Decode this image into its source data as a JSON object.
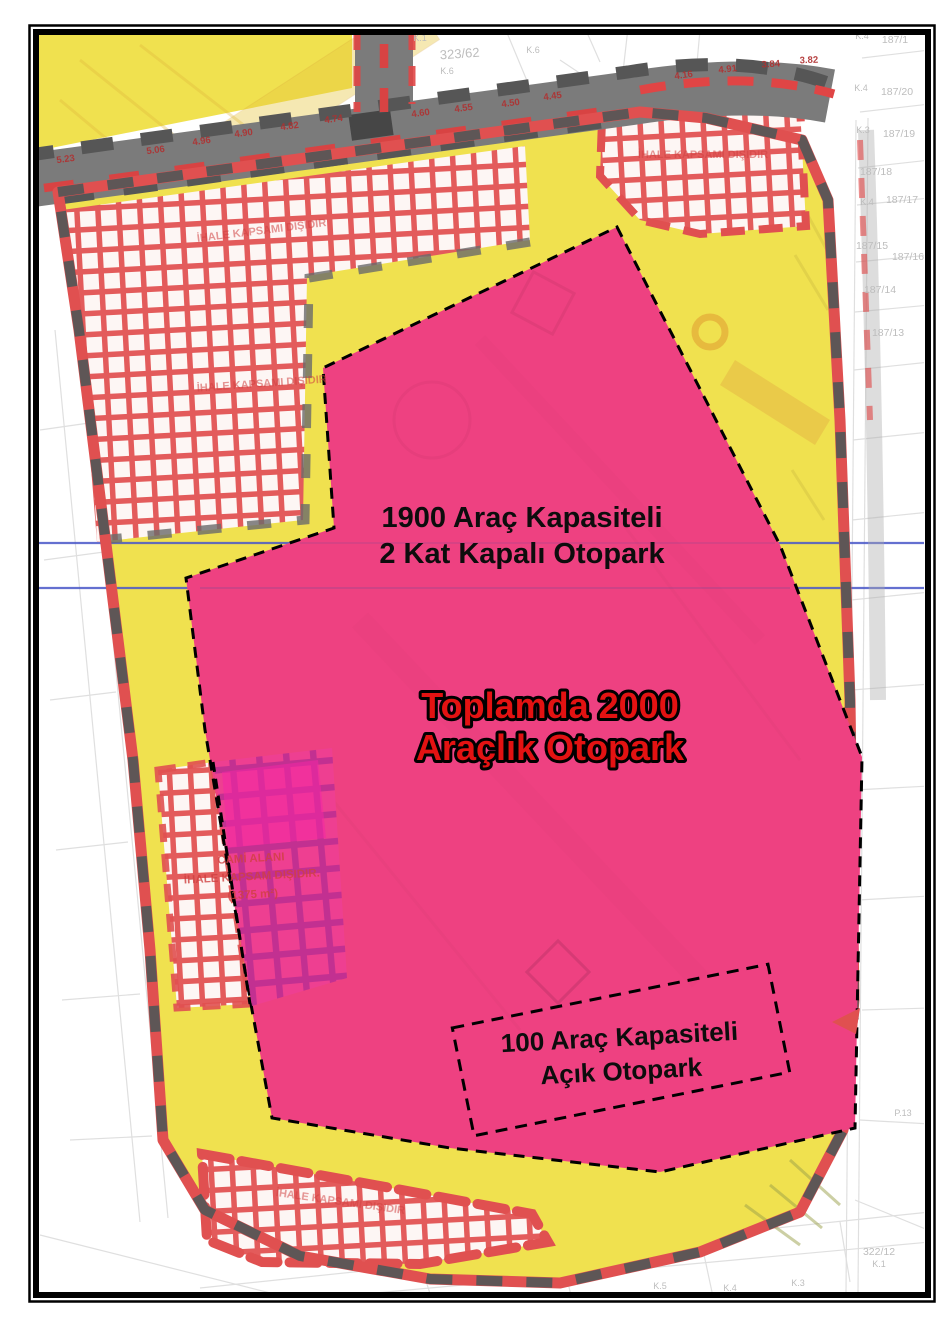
{
  "map_type": "zoning-parking-plan",
  "colors": {
    "pink": "#ee4181",
    "yellow": "#f0e14f",
    "roadGray": "#7b7b7b",
    "dashGray": "#565656",
    "bandRed": "#e05050",
    "gridRed": "#e35b5b",
    "magGridBg": "#ee3f92",
    "magGridLine": "#c02f92",
    "brightMagenta": "#f426a6",
    "blueLine": "#4a58c8",
    "labelRed": "#e31212",
    "faintGray": "#bdbdbd",
    "elevRed": "#b03030",
    "excludedRed": "#d04040"
  },
  "labels": {
    "covered1": "1900 Araç Kapasiteli",
    "covered2": "2 Kat Kapalı Otopark",
    "total1": "Toplamda 2000",
    "total2": "Araçlık Otopark",
    "open1": "100 Araç Kapasiteli",
    "open2": "Açık Otopark"
  },
  "excluded": {
    "text": "İHALE KAPSAMI DIŞIDIR",
    "mosque1": "CAMİ ALANI",
    "mosque2": "İHALE KAPSAM DIŞIDIR.",
    "mosque3": "(1375 m²)"
  },
  "parcels": [
    "187/1",
    "187/20",
    "187/19",
    "187/18",
    "187/17",
    "187/15",
    "187/16",
    "187/14",
    "187/13",
    "323/62",
    "322/12"
  ],
  "blocks": [
    "K.1",
    "K.6",
    "K.6",
    "K.4",
    "K.4",
    "K.3",
    "K.4",
    "P.13",
    "K.1",
    "K.3",
    "K.4",
    "K.5"
  ],
  "elevations": [
    "5.23",
    "5.06",
    "4.96",
    "4.90",
    "4.82",
    "4.74",
    "4.60",
    "4.55",
    "4.50",
    "4.45",
    "4.16",
    "4.91",
    "3.84",
    "3.82"
  ]
}
